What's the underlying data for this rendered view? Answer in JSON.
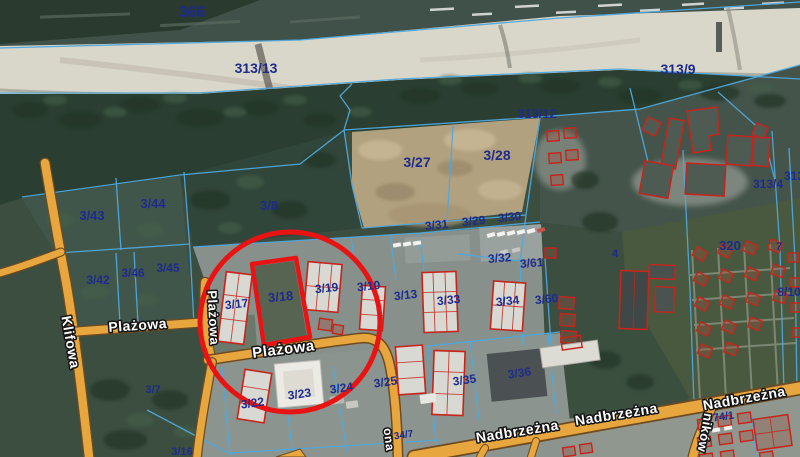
{
  "map": {
    "highlighted_parcel": "3/18",
    "colors": {
      "boundary": "#4fa8dc",
      "parcel_text": "#1e2b8c",
      "road": "#e8a63f",
      "road_edge": "#6e4b20",
      "building": "#c6251c",
      "highlight": "#e81313",
      "street_text": "#ffffff",
      "street_outline": "#141414"
    },
    "parcel_labels": [
      {
        "text": "366",
        "x": 192,
        "y": 17,
        "fs": 16,
        "rot": 0
      },
      {
        "text": "313/13",
        "x": 256,
        "y": 73,
        "fs": 14,
        "rot": 0
      },
      {
        "text": "313/9",
        "x": 678,
        "y": 74,
        "fs": 14,
        "rot": 0
      },
      {
        "text": "313/12",
        "x": 537,
        "y": 118,
        "fs": 13,
        "rot": 0
      },
      {
        "text": "3/27",
        "x": 417,
        "y": 167,
        "fs": 14,
        "rot": 0
      },
      {
        "text": "3/28",
        "x": 497,
        "y": 160,
        "fs": 14,
        "rot": 0
      },
      {
        "text": "3/8",
        "x": 269,
        "y": 210,
        "fs": 13,
        "rot": 0
      },
      {
        "text": "3/43",
        "x": 92,
        "y": 220,
        "fs": 13,
        "rot": 0
      },
      {
        "text": "3/44",
        "x": 153,
        "y": 208,
        "fs": 13,
        "rot": 0
      },
      {
        "text": "3/31",
        "x": 437,
        "y": 229,
        "fs": 12,
        "rot": -6
      },
      {
        "text": "3/29",
        "x": 474,
        "y": 225,
        "fs": 12,
        "rot": -6
      },
      {
        "text": "3/30",
        "x": 510,
        "y": 221,
        "fs": 12,
        "rot": -6
      },
      {
        "text": "3/42",
        "x": 98,
        "y": 284,
        "fs": 12,
        "rot": 0
      },
      {
        "text": "3/46",
        "x": 133,
        "y": 277,
        "fs": 12,
        "rot": 0
      },
      {
        "text": "3/45",
        "x": 168,
        "y": 272,
        "fs": 12,
        "rot": 0
      },
      {
        "text": "3/32",
        "x": 500,
        "y": 262,
        "fs": 12,
        "rot": -5
      },
      {
        "text": "3/61",
        "x": 532,
        "y": 267,
        "fs": 12,
        "rot": -5
      },
      {
        "text": "4",
        "x": 615,
        "y": 257,
        "fs": 11,
        "rot": 0
      },
      {
        "text": "320",
        "x": 730,
        "y": 250,
        "fs": 13,
        "rot": 0
      },
      {
        "text": "7",
        "x": 779,
        "y": 250,
        "fs": 11,
        "rot": 0
      },
      {
        "text": "3/17",
        "x": 237,
        "y": 308,
        "fs": 12,
        "rot": -6
      },
      {
        "text": "3/18",
        "x": 281,
        "y": 301,
        "fs": 13,
        "rot": -5
      },
      {
        "text": "3/19",
        "x": 327,
        "y": 292,
        "fs": 12,
        "rot": -6
      },
      {
        "text": "3/10",
        "x": 369,
        "y": 290,
        "fs": 12,
        "rot": -6
      },
      {
        "text": "3/13",
        "x": 406,
        "y": 299,
        "fs": 12,
        "rot": -6
      },
      {
        "text": "3/33",
        "x": 449,
        "y": 304,
        "fs": 12,
        "rot": -6
      },
      {
        "text": "3/34",
        "x": 508,
        "y": 305,
        "fs": 12,
        "rot": -6
      },
      {
        "text": "3/60",
        "x": 547,
        "y": 303,
        "fs": 12,
        "rot": -6
      },
      {
        "text": "8/10",
        "x": 789,
        "y": 296,
        "fs": 12,
        "rot": 0
      },
      {
        "text": "313/4",
        "x": 768,
        "y": 188,
        "fs": 12,
        "rot": 0
      },
      {
        "text": "313",
        "x": 794,
        "y": 180,
        "fs": 12,
        "rot": 0
      },
      {
        "text": "3/7",
        "x": 153,
        "y": 393,
        "fs": 11,
        "rot": 0
      },
      {
        "text": "3/22",
        "x": 253,
        "y": 407,
        "fs": 12,
        "rot": -8
      },
      {
        "text": "3/23",
        "x": 300,
        "y": 398,
        "fs": 12,
        "rot": -8
      },
      {
        "text": "3/24",
        "x": 342,
        "y": 392,
        "fs": 12,
        "rot": -8
      },
      {
        "text": "3/25",
        "x": 386,
        "y": 386,
        "fs": 12,
        "rot": -8
      },
      {
        "text": "3/35",
        "x": 465,
        "y": 384,
        "fs": 12,
        "rot": -8
      },
      {
        "text": "3/36",
        "x": 520,
        "y": 377,
        "fs": 12,
        "rot": -8
      },
      {
        "text": "74/1",
        "x": 724,
        "y": 420,
        "fs": 11,
        "rot": -8
      },
      {
        "text": "34/7",
        "x": 404,
        "y": 438,
        "fs": 10,
        "rot": -8
      },
      {
        "text": "3/16",
        "x": 182,
        "y": 455,
        "fs": 11,
        "rot": 0
      }
    ],
    "street_labels": [
      {
        "text": "Plażowa",
        "x": 138,
        "y": 330,
        "rot": -4,
        "fs": 14
      },
      {
        "text": "Plażowa",
        "x": 209,
        "y": 318,
        "rot": 87,
        "fs": 13
      },
      {
        "text": "Plażowa",
        "x": 284,
        "y": 354,
        "rot": -7,
        "fs": 15
      },
      {
        "text": "Klifowa",
        "x": 66,
        "y": 343,
        "rot": 80,
        "fs": 14
      },
      {
        "text": "Nadbrzeżna",
        "x": 518,
        "y": 436,
        "rot": -9,
        "fs": 14
      },
      {
        "text": "Nadbrzeżna",
        "x": 617,
        "y": 419,
        "rot": -9,
        "fs": 14
      },
      {
        "text": "Nadbrzeżna",
        "x": 745,
        "y": 403,
        "rot": -10,
        "fs": 14
      },
      {
        "text": "ników",
        "x": 701,
        "y": 432,
        "rot": 100,
        "fs": 13
      },
      {
        "text": "ona",
        "x": 385,
        "y": 440,
        "rot": 83,
        "fs": 12
      }
    ]
  }
}
